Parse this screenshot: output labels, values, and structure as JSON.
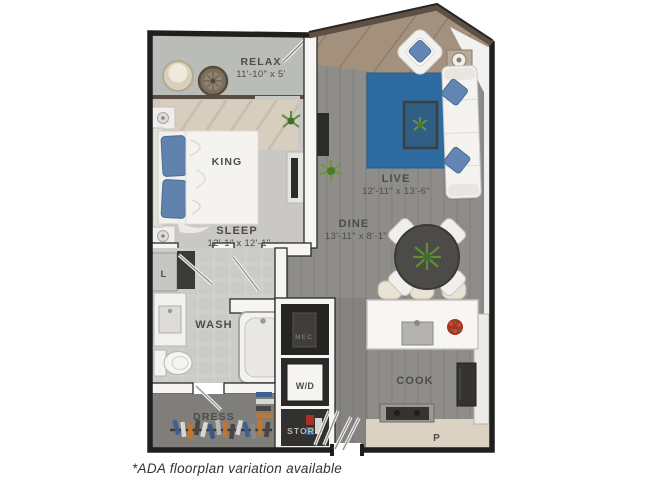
{
  "floorplan": {
    "rooms": {
      "relax": {
        "label": "RELAX",
        "dims": "11'-10\" x 5'"
      },
      "sleep": {
        "label": "SLEEP",
        "dims": "12'-1\" x 12'-1\""
      },
      "bed": {
        "label": "KING"
      },
      "live": {
        "label": "LIVE",
        "dims": "12'-11\" x 13'-6\""
      },
      "dine": {
        "label": "DINE",
        "dims": "13'-11\" x 8'-1\""
      },
      "wash": {
        "label": "WASH"
      },
      "dress": {
        "label": "DRESS"
      },
      "cook": {
        "label": "COOK"
      },
      "wd": {
        "label": "W/D"
      },
      "stor": {
        "label": "STOR"
      },
      "mec": {
        "label": "MEC"
      },
      "linen": {
        "label": "L"
      },
      "pantry": {
        "label": "P"
      }
    },
    "footnote": "*ADA floorplan variation available",
    "colors": {
      "wood_floor": "#8f8d89",
      "carpet": "#c9c8c5",
      "balcony_floor": "#b9bcb7",
      "tile": "#cbcbc9",
      "dress_floor": "#7f7e7b",
      "walls_dark": "#1f1f1f",
      "roof_brown": "#5e5045",
      "rug_blue": "#2d6ba0",
      "pillow_blue": "#6285b4",
      "plant_green": "#6f9438",
      "accent_red": "#a83226",
      "pantry_beige": "#dcd2c4",
      "label_gray": "#4d4c4a"
    }
  }
}
